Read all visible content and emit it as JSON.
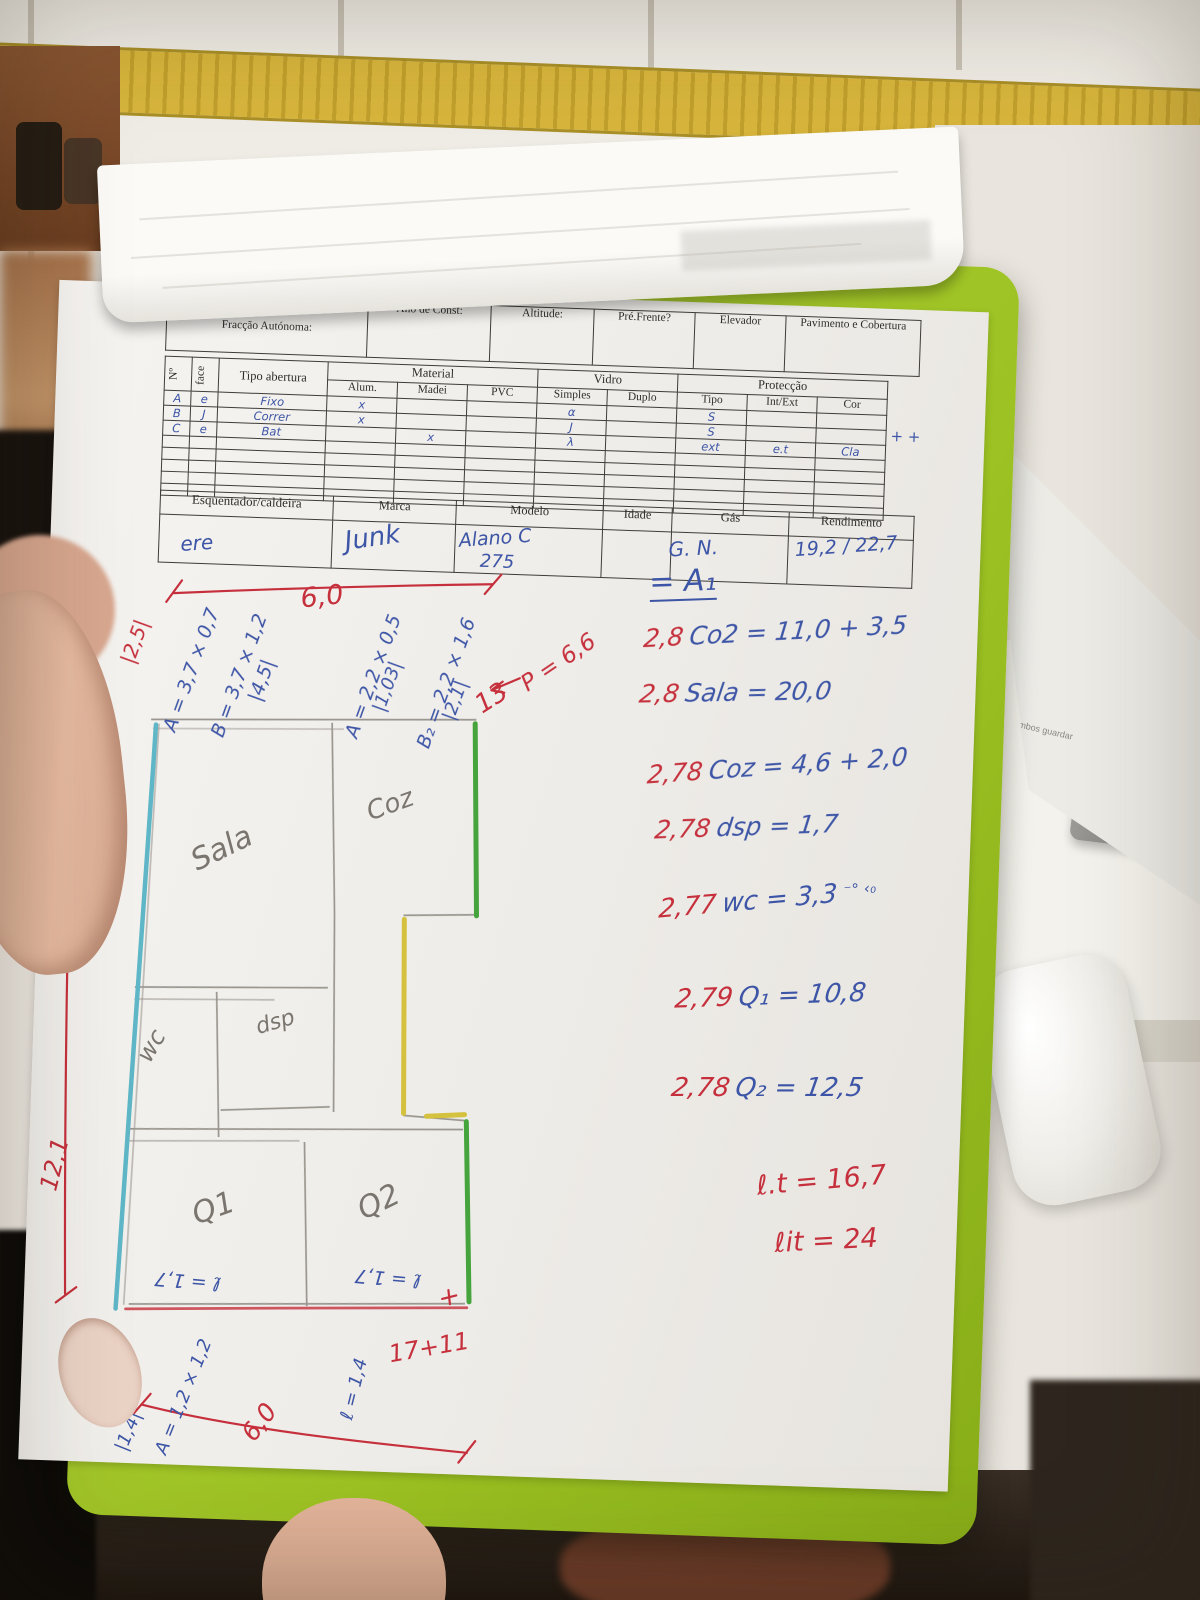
{
  "colors": {
    "clipboard_green": "#9cc223",
    "ink_red": "#c5303c",
    "ink_blue": "#3d55a6",
    "pencil": "#7a756e",
    "tile_strip": "#d7b53c"
  },
  "form": {
    "header": {
      "fraccao_label": "Fracção Autónoma:",
      "ano_label": "Ano de Const:",
      "altitude_label": "Altitude:",
      "pre_frente_label": "Pré.Frente?",
      "elevador_label": "Elevador",
      "pavimento_label": "Pavimento e Cobertura"
    },
    "openings": {
      "no_label": "Nº",
      "face_label": "face",
      "tipo_abertura_label": "Tipo abertura",
      "material_label": "Material",
      "material_cols": [
        "Alum.",
        "Madei",
        "PVC"
      ],
      "vidro_label": "Vidro",
      "vidro_cols": [
        "Simples",
        "Duplo"
      ],
      "proteccao_label": "Protecção",
      "proteccao_cols": [
        "Tipo",
        "Int/Ext",
        "Cor"
      ],
      "rows": [
        {
          "no": "A",
          "face": "e",
          "tipo": "Fixo",
          "alum": "x",
          "madei": "",
          "pvc": "",
          "simples": "α",
          "duplo": "",
          "ptipo": "S",
          "intext": "",
          "cor": ""
        },
        {
          "no": "B",
          "face": "J",
          "tipo": "Correr",
          "alum": "x",
          "madei": "",
          "pvc": "",
          "simples": "J",
          "duplo": "",
          "ptipo": "S",
          "intext": "",
          "cor": ""
        },
        {
          "no": "C",
          "face": "e",
          "tipo": "Bat",
          "alum": "",
          "madei": "x",
          "pvc": "",
          "simples": "λ",
          "duplo": "",
          "ptipo": "ext",
          "intext": "e.t",
          "cor": "Cla"
        }
      ],
      "extra_marks": "+ +"
    },
    "heater": {
      "title": "Esquentador/caldeira",
      "marca_label": "Marca",
      "modelo_label": "Modelo",
      "idade_label": "Idade",
      "gas_label": "Gás",
      "rendimento_label": "Rendimento",
      "values": {
        "tipo": "ere",
        "marca": "Junk",
        "modelo_line1": "Alano C",
        "modelo_line2": "275",
        "idade": "",
        "gas": "G. N.",
        "rendimento": "19,2 / 22,7"
      }
    }
  },
  "plan": {
    "rooms": {
      "sala": "Sala",
      "coz": "Coz",
      "wc": "wc",
      "dsp": "dsp",
      "q1": "Q1",
      "q2": "Q2"
    },
    "dims": {
      "left": "12,1",
      "top": "6,0",
      "bottom": "6,0",
      "thirteen": "13",
      "p": "P = 6,6",
      "seventeen": "17+11"
    },
    "left_notes": [
      "|2,5|",
      "A = 3,7 × 0,7",
      "B = 3,7 × 1,2",
      "|4,5|",
      "A = 2,2 × 0,5",
      "|1,03|",
      "B₂ = 2,2 × 1,6",
      "|2,1|"
    ],
    "bottom_notes": [
      "ℓ = 1,7",
      "ℓ = 1,7",
      "ℓ = 1,4",
      "A = 1,2 × 1,2",
      "|1,4|"
    ]
  },
  "calcs": {
    "heading": "= A₁",
    "lines": [
      {
        "coef": "2,8",
        "expr": "Co2 = 11,0 + 3,5"
      },
      {
        "coef": "2,8",
        "expr": "Sala = 20,0"
      },
      {
        "coef": "2,78",
        "expr": "Coz = 4,6 + 2,0"
      },
      {
        "coef": "2,78",
        "expr": "dsp = 1,7"
      },
      {
        "coef": "2,77",
        "expr": "wc = 3,3"
      },
      {
        "coef": "2,79",
        "expr": "Q₁ = 10,8"
      },
      {
        "coef": "2,78",
        "expr": "Q₂ = 12,5"
      }
    ],
    "wc_marks": "⁻° ‹₀",
    "totals": [
      "ℓ.t = 16,7",
      "ℓit = 24"
    ]
  },
  "side_paper": {
    "line1": "ambos guardar",
    "line2": "MobileDedPropCert v.5"
  }
}
